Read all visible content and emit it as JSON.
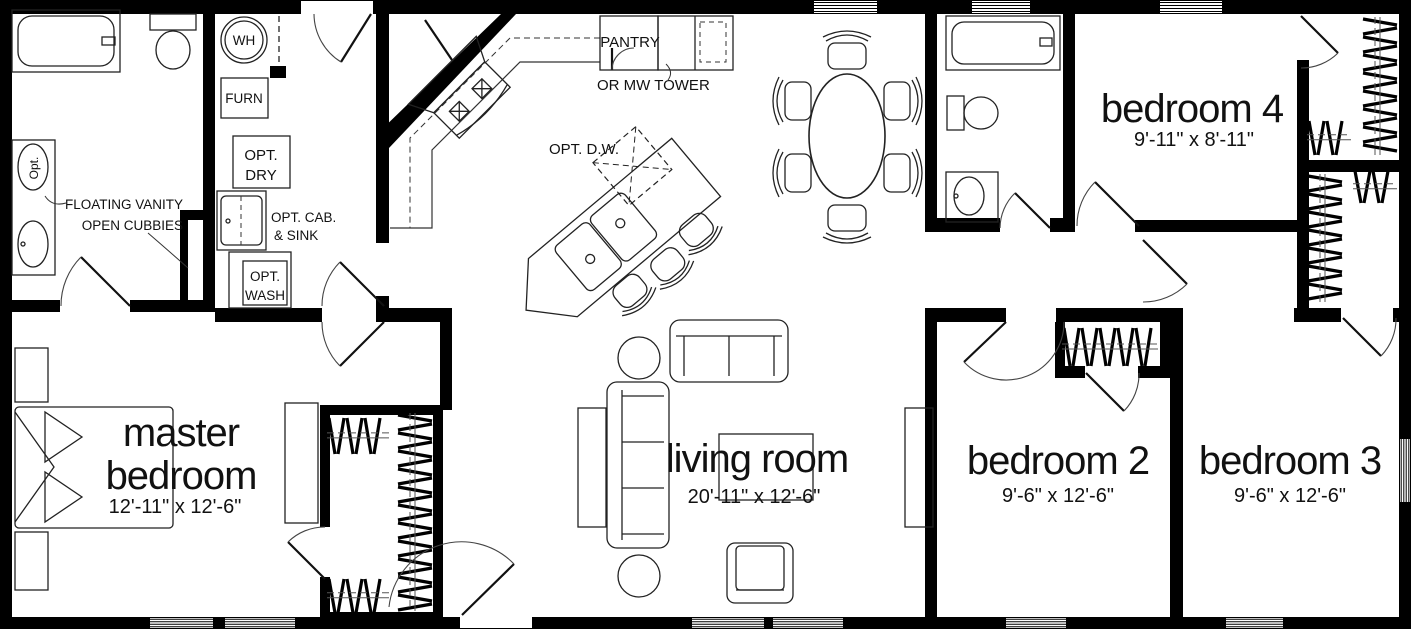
{
  "plan": {
    "title": "single-story manufactured home floor plan",
    "rooms": {
      "master_bedroom": {
        "label_line1": "master",
        "label_line2": "bedroom",
        "dims": "12'-11\" x 12'-6\""
      },
      "living_room": {
        "label": "living room",
        "dims": "20'-11\" x 12'-6\""
      },
      "bedroom_2": {
        "label": "bedroom 2",
        "dims": "9'-6\" x 12'-6\""
      },
      "bedroom_3": {
        "label": "bedroom 3",
        "dims": "9'-6\" x 12'-6\""
      },
      "bedroom_4": {
        "label": "bedroom 4",
        "dims": "9'-11\" x 8'-11\""
      }
    },
    "annotations": {
      "wh": "WH",
      "furn": "FURN",
      "opt_dry_line1": "OPT.",
      "opt_dry_line2": "DRY",
      "opt_cab_line1": "OPT. CAB.",
      "opt_cab_line2": "& SINK",
      "opt_wash_line1": "OPT.",
      "opt_wash_line2": "WASH",
      "vanity_line1": "FLOATING VANITY",
      "vanity_line2": "OPEN CUBBIES",
      "vanity_opt": "Opt.",
      "pantry": "PANTRY",
      "pantry_alt": "OR MW TOWER",
      "opt_dw": "OPT. D.W."
    },
    "colors": {
      "wall": "#000000",
      "line": "#222222",
      "background": "#ffffff"
    }
  }
}
